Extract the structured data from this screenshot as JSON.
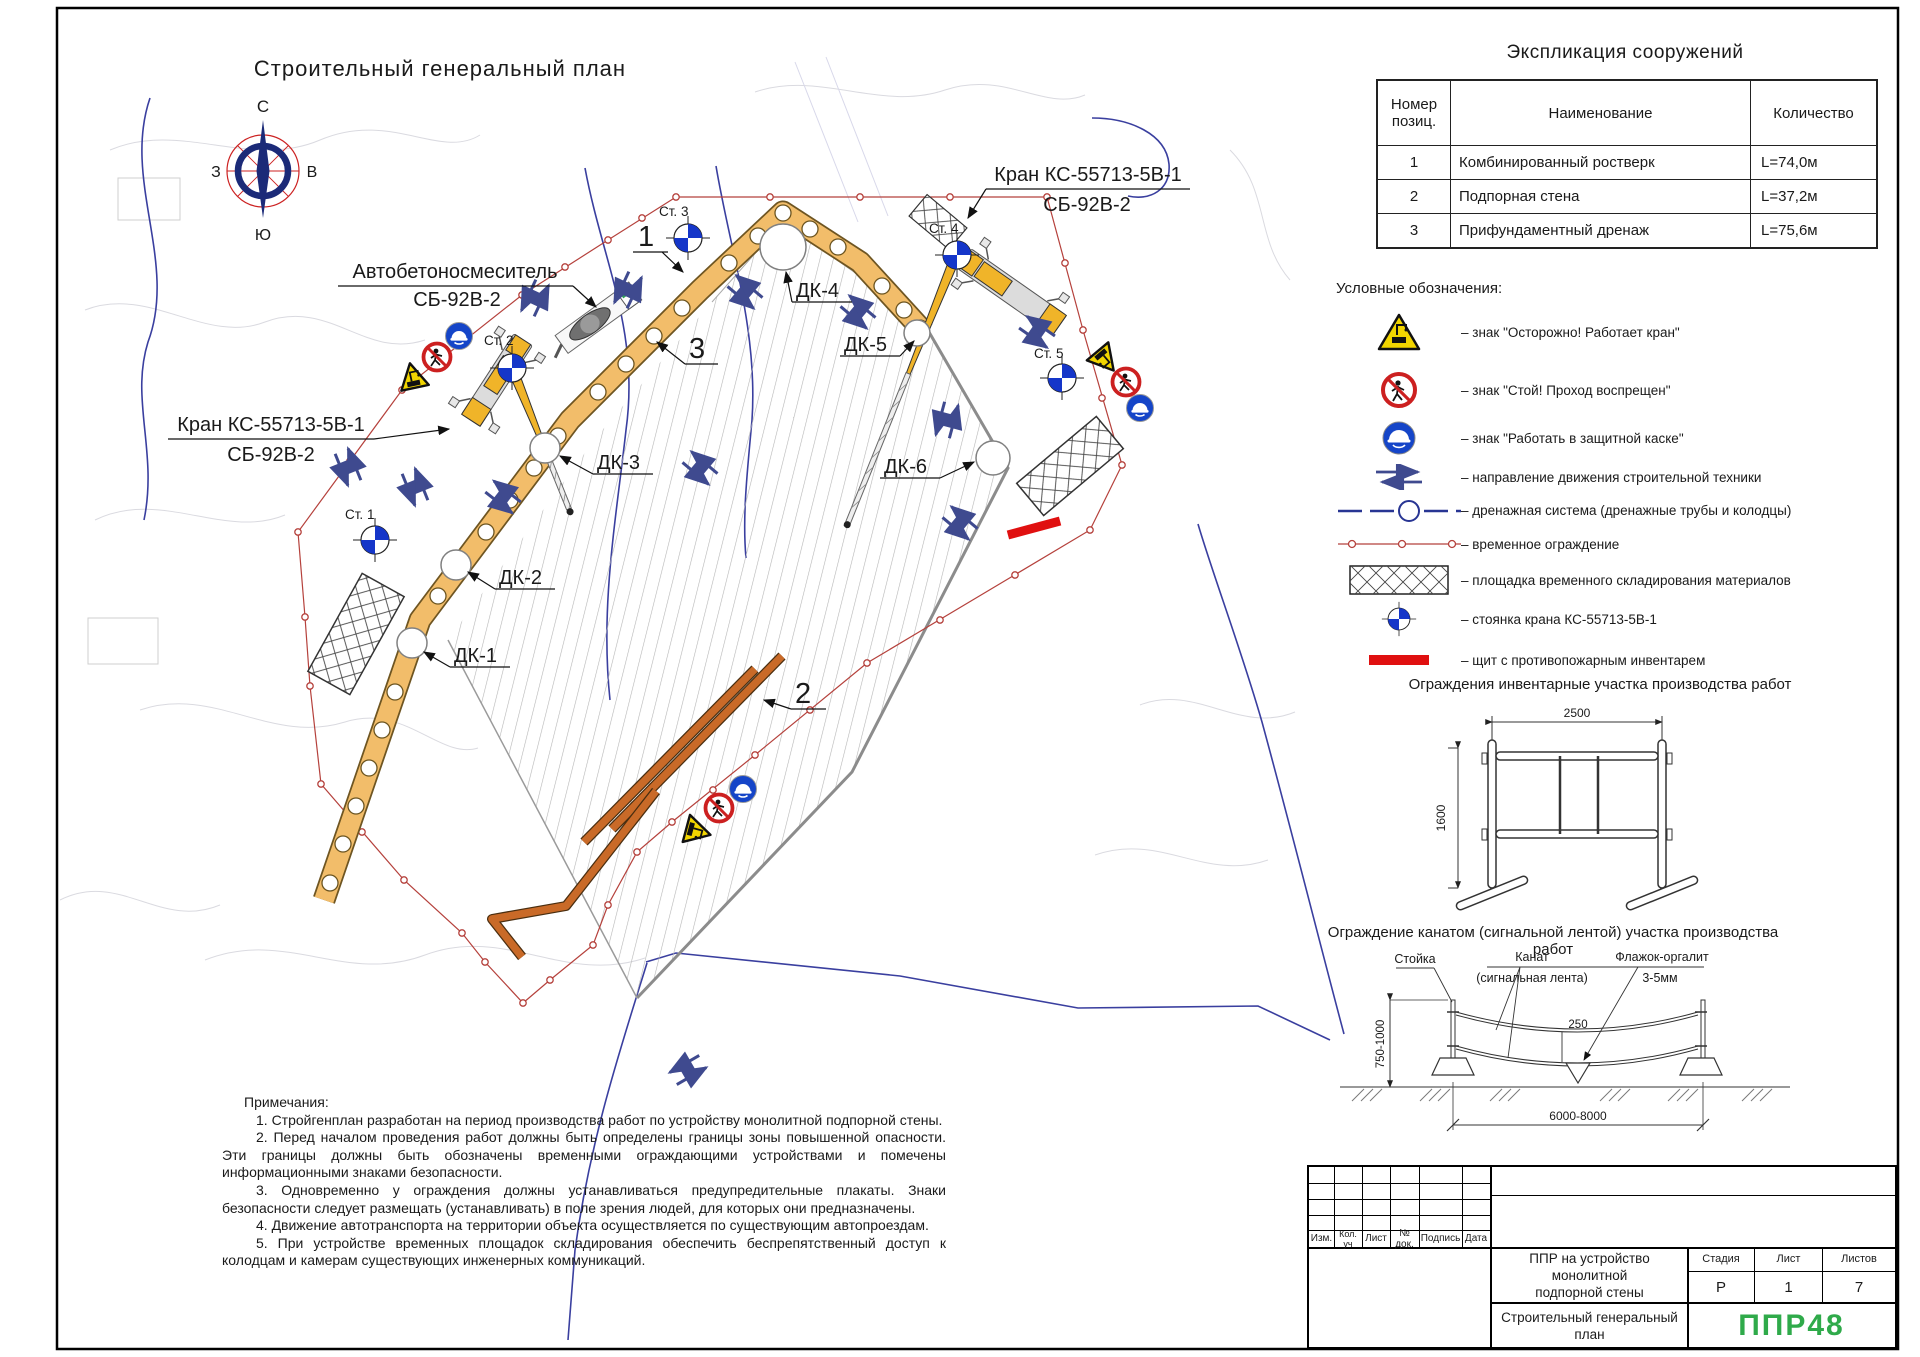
{
  "sheet": {
    "plan_title": "Строительный генеральный план",
    "compass": {
      "n": "С",
      "e": "В",
      "s": "Ю",
      "w": "З"
    }
  },
  "plan": {
    "labels": {
      "crane_left_l1": "Кран КС-55713-5В-1",
      "crane_left_l2": "СБ-92В-2",
      "crane_right_l1": "Кран КС-55713-5В-1",
      "crane_right_l2": "СБ-92В-2",
      "mixer_l1": "Автобетоносмеситель",
      "mixer_l2": "СБ-92В-2",
      "st1": "Ст. 1",
      "st2": "Ст. 2",
      "st3": "Ст. 3",
      "st4": "Ст. 4",
      "st5": "Ст. 5",
      "dk1": "ДК-1",
      "dk2": "ДК-2",
      "dk3": "ДК-3",
      "dk4": "ДК-4",
      "dk5": "ДК-5",
      "dk6": "ДК-6",
      "pos1": "1",
      "pos2": "2",
      "pos3": "3"
    }
  },
  "explication": {
    "title": "Экспликация сооружений",
    "col_num_l1": "Номер",
    "col_num_l2": "позиц.",
    "col_name": "Наименование",
    "col_qty": "Количество",
    "rows": [
      {
        "num": "1",
        "name": "Комбинированный ростверк",
        "qty": "L=74,0м"
      },
      {
        "num": "2",
        "name": "Подпорная стена",
        "qty": "L=37,2м"
      },
      {
        "num": "3",
        "name": "Прифундаментный дренаж",
        "qty": "L=75,6м"
      }
    ]
  },
  "legend": {
    "title": "Условные обозначения:",
    "items": [
      {
        "icon": "crane-warning-sign",
        "label": "– знак \"Осторожно! Работает кран\""
      },
      {
        "icon": "no-pedestrians-sign",
        "label": "– знак \"Стой! Проход воспрещен\""
      },
      {
        "icon": "hard-hat-sign",
        "label": "– знак \"Работать в защитной каске\""
      },
      {
        "icon": "direction-arrows",
        "label": "– направление движения строительной техники"
      },
      {
        "icon": "drainage-line",
        "label": "– дренажная система (дренажные трубы и колодцы)"
      },
      {
        "icon": "temporary-fence",
        "label": "– временное ограждение"
      },
      {
        "icon": "storage-area",
        "label": "– площадка временного складирования материалов"
      },
      {
        "icon": "crane-stand",
        "label": "– стоянка крана КС-55713-5В-1"
      },
      {
        "icon": "fire-shield",
        "label": "– щит с противопожарным инвентарем"
      }
    ]
  },
  "fence1": {
    "title": "Ограждения инвентарные участка производства работ",
    "dim_width": "2500",
    "dim_height": "1600"
  },
  "fence2": {
    "title": "Ограждение канатом (сигнальной лентой) участка производства работ",
    "label_post": "Стойка",
    "label_rope_l1": "Канат",
    "label_rope_l2": "(сигнальная лента)",
    "label_flag_l1": "Флажок-оргалит",
    "label_flag_l2": "3-5мм",
    "dim_height": "750-1000",
    "dim_flag": "250",
    "dim_span": "6000-8000"
  },
  "notes": {
    "title": "Примечания:",
    "items": [
      "1. Стройгенплан разработан на период производства работ по устройству монолитной подпорной стены.",
      "2. Перед началом проведения работ должны быть определены границы зоны повышенной опасности. Эти границы должны быть обозначены временными ограждающими устройствами и помечены информационными знаками безопасности.",
      "3. Одновременно у ограждения должны устанавливаться предупредительные плакаты. Знаки безопасности следует размещать (устанавливать) в поле зрения людей, для которых они предназначены.",
      "4. Движение автотранспорта на территории объекта осуществляется по существующим автопроездам.",
      "5. При устройстве временных площадок складирования обеспечить беспрепятственный доступ к колодцам и камерам существующих инженерных коммуникаций."
    ]
  },
  "titleblock": {
    "cols": [
      "Изм.",
      "Кол. уч",
      "Лист",
      "№ док.",
      "Подпись",
      "Дата"
    ],
    "doc_l1": "ППР на устройство монолитной",
    "doc_l2": "подпорной стены",
    "stage_h": "Стадия",
    "sheet_h": "Лист",
    "sheets_h": "Листов",
    "stage": "Р",
    "sheet": "1",
    "sheets": "7",
    "name_l1": "Строительный генеральный",
    "name_l2": "план",
    "logo": "ППР48"
  },
  "colors": {
    "fence_red": "#b5413c",
    "boundary_blue": "#3a3f9f",
    "pile_fill": "#f2bd6a",
    "wall_orange": "#c96a28",
    "arrow_navy": "#3f4a8f",
    "crane_yellow": "#f0b429",
    "sign_blue": "#1545c8",
    "sign_red": "#cc2020",
    "sign_yellow": "#f2d500",
    "shield_red": "#e01010",
    "logo_green": "#2faa4a"
  }
}
